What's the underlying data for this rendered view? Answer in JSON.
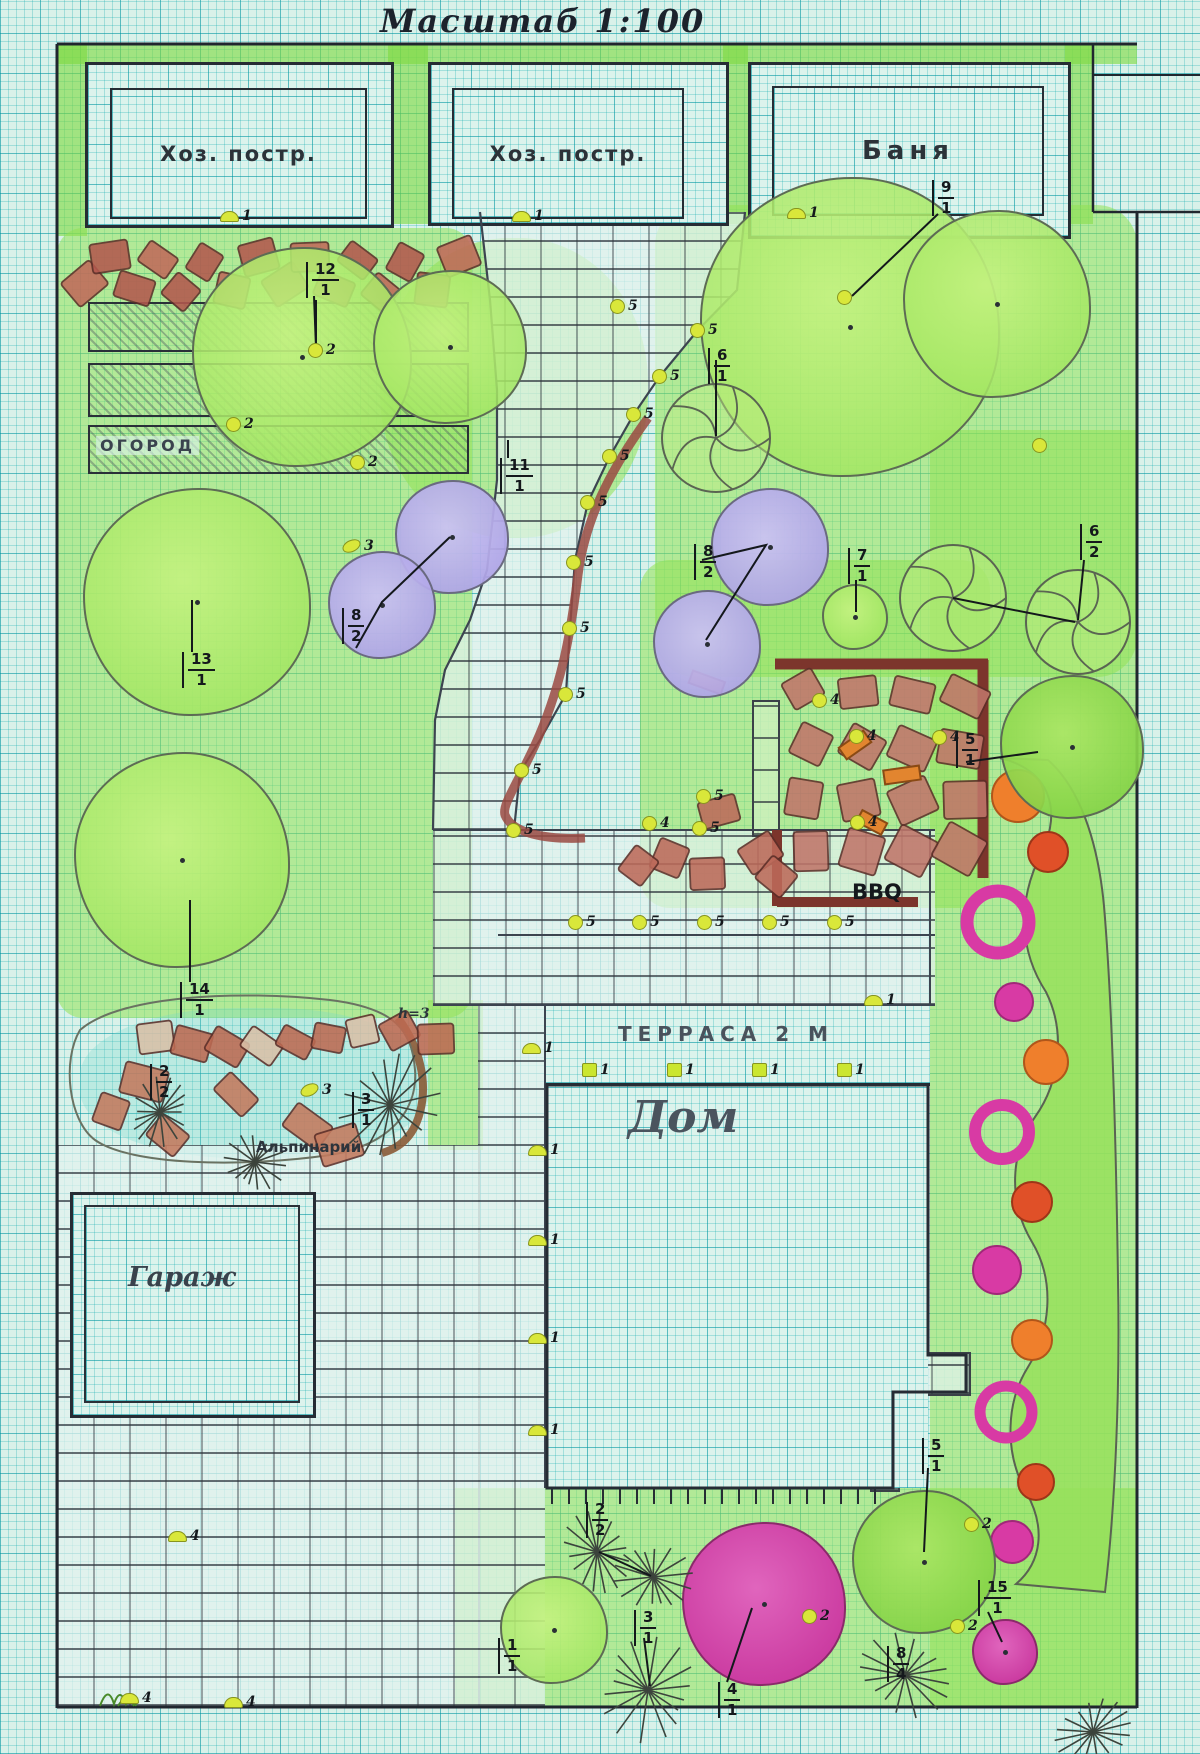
{
  "title": "Масштаб 1:100",
  "buildings": [
    {
      "label": "Хоз. постр."
    },
    {
      "label": "Хоз. постр."
    },
    {
      "label": "Баня"
    }
  ],
  "areas": {
    "vegetable_garden": "ОГОРОД",
    "garage": "Гараж",
    "house": "Дом",
    "terrace": "ТЕРРАСА 2 М",
    "rock_garden": "Альпинарий",
    "bbq": "BBQ",
    "height_note": "h=3"
  },
  "colors": {
    "paper": "#d9f1e9",
    "grid": "#00919e",
    "lawn": "#92e254",
    "stone": "#b3584e",
    "curb": "#7c352c",
    "flower_magenta": "#d83aa4",
    "flower_orange": "#ef7f2c",
    "marker_yellow": "#d9e73a"
  },
  "plant_markers": [
    {
      "num": "12",
      "den": "1",
      "x": 306,
      "y": 262
    },
    {
      "num": "9",
      "den": "1",
      "x": 932,
      "y": 180
    },
    {
      "num": "11",
      "den": "1",
      "x": 500,
      "y": 458
    },
    {
      "num": "6",
      "den": "1",
      "x": 708,
      "y": 348
    },
    {
      "num": "8",
      "den": "2",
      "x": 694,
      "y": 544
    },
    {
      "num": "7",
      "den": "1",
      "x": 848,
      "y": 548
    },
    {
      "num": "6",
      "den": "2",
      "x": 1080,
      "y": 524
    },
    {
      "num": "5",
      "den": "1",
      "x": 956,
      "y": 732
    },
    {
      "num": "8",
      "den": "2",
      "x": 342,
      "y": 608
    },
    {
      "num": "13",
      "den": "1",
      "x": 182,
      "y": 652
    },
    {
      "num": "14",
      "den": "1",
      "x": 180,
      "y": 982
    },
    {
      "num": "2",
      "den": "2",
      "x": 150,
      "y": 1064
    },
    {
      "num": "3",
      "den": "1",
      "x": 352,
      "y": 1092
    },
    {
      "num": "2",
      "den": "2",
      "x": 586,
      "y": 1502
    },
    {
      "num": "3",
      "den": "1",
      "x": 634,
      "y": 1610
    },
    {
      "num": "1",
      "den": "1",
      "x": 498,
      "y": 1638
    },
    {
      "num": "4",
      "den": "1",
      "x": 718,
      "y": 1682
    },
    {
      "num": "5",
      "den": "1",
      "x": 922,
      "y": 1438
    },
    {
      "num": "8",
      "den": "4",
      "x": 887,
      "y": 1646
    },
    {
      "num": "15",
      "den": "1",
      "x": 978,
      "y": 1580
    }
  ],
  "dot_markers": [
    {
      "label": "1",
      "shape": "dome",
      "x": 228,
      "y": 216
    },
    {
      "label": "1",
      "shape": "dome",
      "x": 520,
      "y": 216
    },
    {
      "label": "1",
      "shape": "dome",
      "x": 795,
      "y": 213
    },
    {
      "label": "2",
      "shape": "circle",
      "x": 316,
      "y": 350
    },
    {
      "label": "2",
      "shape": "circle",
      "x": 234,
      "y": 424
    },
    {
      "label": "2",
      "shape": "circle",
      "x": 358,
      "y": 462
    },
    {
      "label": "3",
      "shape": "blob",
      "x": 350,
      "y": 546
    },
    {
      "label": "3",
      "shape": "blob",
      "x": 308,
      "y": 1090
    },
    {
      "label": "5",
      "shape": "circle",
      "x": 618,
      "y": 306
    },
    {
      "label": "5",
      "shape": "circle",
      "x": 698,
      "y": 330
    },
    {
      "label": "5",
      "shape": "circle",
      "x": 660,
      "y": 376
    },
    {
      "label": "5",
      "shape": "circle",
      "x": 634,
      "y": 414
    },
    {
      "label": "5",
      "shape": "circle",
      "x": 610,
      "y": 456
    },
    {
      "label": "5",
      "shape": "circle",
      "x": 588,
      "y": 502
    },
    {
      "label": "5",
      "shape": "circle",
      "x": 574,
      "y": 562
    },
    {
      "label": "5",
      "shape": "circle",
      "x": 570,
      "y": 628
    },
    {
      "label": "5",
      "shape": "circle",
      "x": 566,
      "y": 694
    },
    {
      "label": "5",
      "shape": "circle",
      "x": 522,
      "y": 770
    },
    {
      "label": "5",
      "shape": "circle",
      "x": 514,
      "y": 830
    },
    {
      "label": "5",
      "shape": "circle",
      "x": 704,
      "y": 796
    },
    {
      "label": "5",
      "shape": "circle",
      "x": 700,
      "y": 828
    },
    {
      "label": "5",
      "shape": "circle",
      "x": 576,
      "y": 922
    },
    {
      "label": "5",
      "shape": "circle",
      "x": 640,
      "y": 922
    },
    {
      "label": "5",
      "shape": "circle",
      "x": 705,
      "y": 922
    },
    {
      "label": "5",
      "shape": "circle",
      "x": 770,
      "y": 922
    },
    {
      "label": "5",
      "shape": "circle",
      "x": 835,
      "y": 922
    },
    {
      "label": "4",
      "shape": "circle",
      "x": 820,
      "y": 700
    },
    {
      "label": "4",
      "shape": "circle",
      "x": 857,
      "y": 736
    },
    {
      "label": "4",
      "shape": "circle",
      "x": 940,
      "y": 737
    },
    {
      "label": "4",
      "shape": "circle",
      "x": 858,
      "y": 822
    },
    {
      "label": "4",
      "shape": "circle",
      "x": 650,
      "y": 823
    },
    {
      "label": "1",
      "shape": "square",
      "x": 590,
      "y": 1070
    },
    {
      "label": "1",
      "shape": "square",
      "x": 675,
      "y": 1070
    },
    {
      "label": "1",
      "shape": "square",
      "x": 760,
      "y": 1070
    },
    {
      "label": "1",
      "shape": "square",
      "x": 845,
      "y": 1070
    },
    {
      "label": "1",
      "shape": "dome",
      "x": 530,
      "y": 1048
    },
    {
      "label": "1",
      "shape": "dome",
      "x": 872,
      "y": 1000
    },
    {
      "label": "1",
      "shape": "dome",
      "x": 536,
      "y": 1150
    },
    {
      "label": "1",
      "shape": "dome",
      "x": 536,
      "y": 1240
    },
    {
      "label": "1",
      "shape": "dome",
      "x": 536,
      "y": 1338
    },
    {
      "label": "1",
      "shape": "dome",
      "x": 536,
      "y": 1430
    },
    {
      "label": "2",
      "shape": "circle",
      "x": 810,
      "y": 1616
    },
    {
      "label": "2",
      "shape": "circle",
      "x": 972,
      "y": 1524
    },
    {
      "label": "2",
      "shape": "circle",
      "x": 958,
      "y": 1626
    },
    {
      "label": "4",
      "shape": "dome",
      "x": 176,
      "y": 1536
    },
    {
      "label": "4",
      "shape": "dome",
      "x": 128,
      "y": 1698
    },
    {
      "label": "4",
      "shape": "dome",
      "x": 232,
      "y": 1702
    },
    {
      "label": "",
      "shape": "circle",
      "x": 845,
      "y": 298
    },
    {
      "label": "",
      "shape": "circle",
      "x": 1040,
      "y": 446
    }
  ]
}
